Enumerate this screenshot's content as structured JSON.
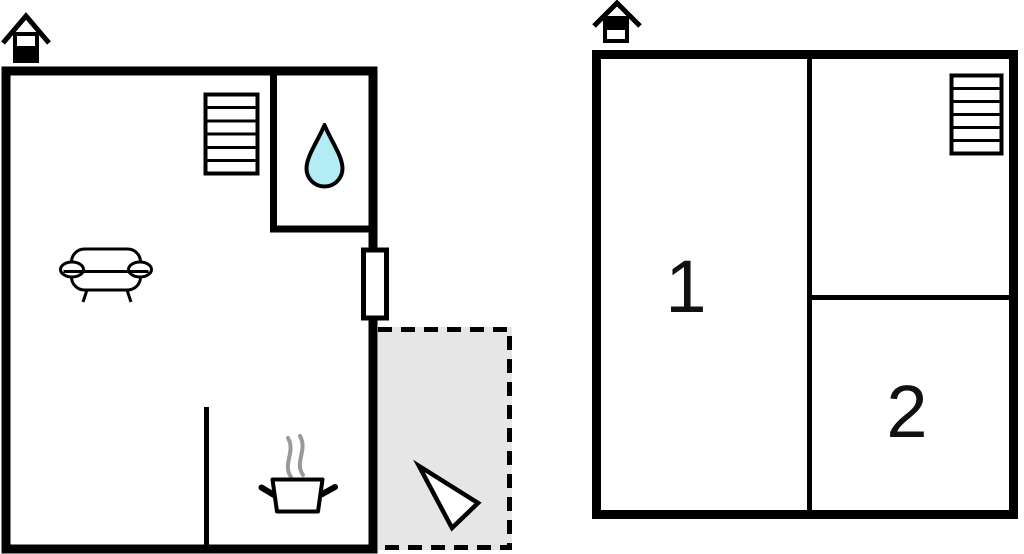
{
  "floorplan": {
    "ground_floor": {
      "level": "ground-floor",
      "level_indicator_icon": "house-with-lower-half-filled",
      "features": [
        "staircase-6-steps",
        "bathroom-water-drop",
        "sofa",
        "door-on-right-wall",
        "kitchen-partition",
        "cooking-pot-with-steam",
        "terrace-dashed-area",
        "direction-arrow"
      ]
    },
    "upper_floor": {
      "level": "upper-floor",
      "level_indicator_icon": "house-with-upper-half-filled",
      "rooms": [
        {
          "number": "1"
        },
        {
          "number": "2"
        }
      ],
      "features": [
        "staircase-6-steps"
      ]
    }
  },
  "colors": {
    "wall": "#000000",
    "water_drop_fill": "#b3ecf5",
    "terrace_fill": "#e6e6e6",
    "steam": "#999999",
    "arrow_fill": "#ffffff",
    "background": "#ffffff"
  }
}
